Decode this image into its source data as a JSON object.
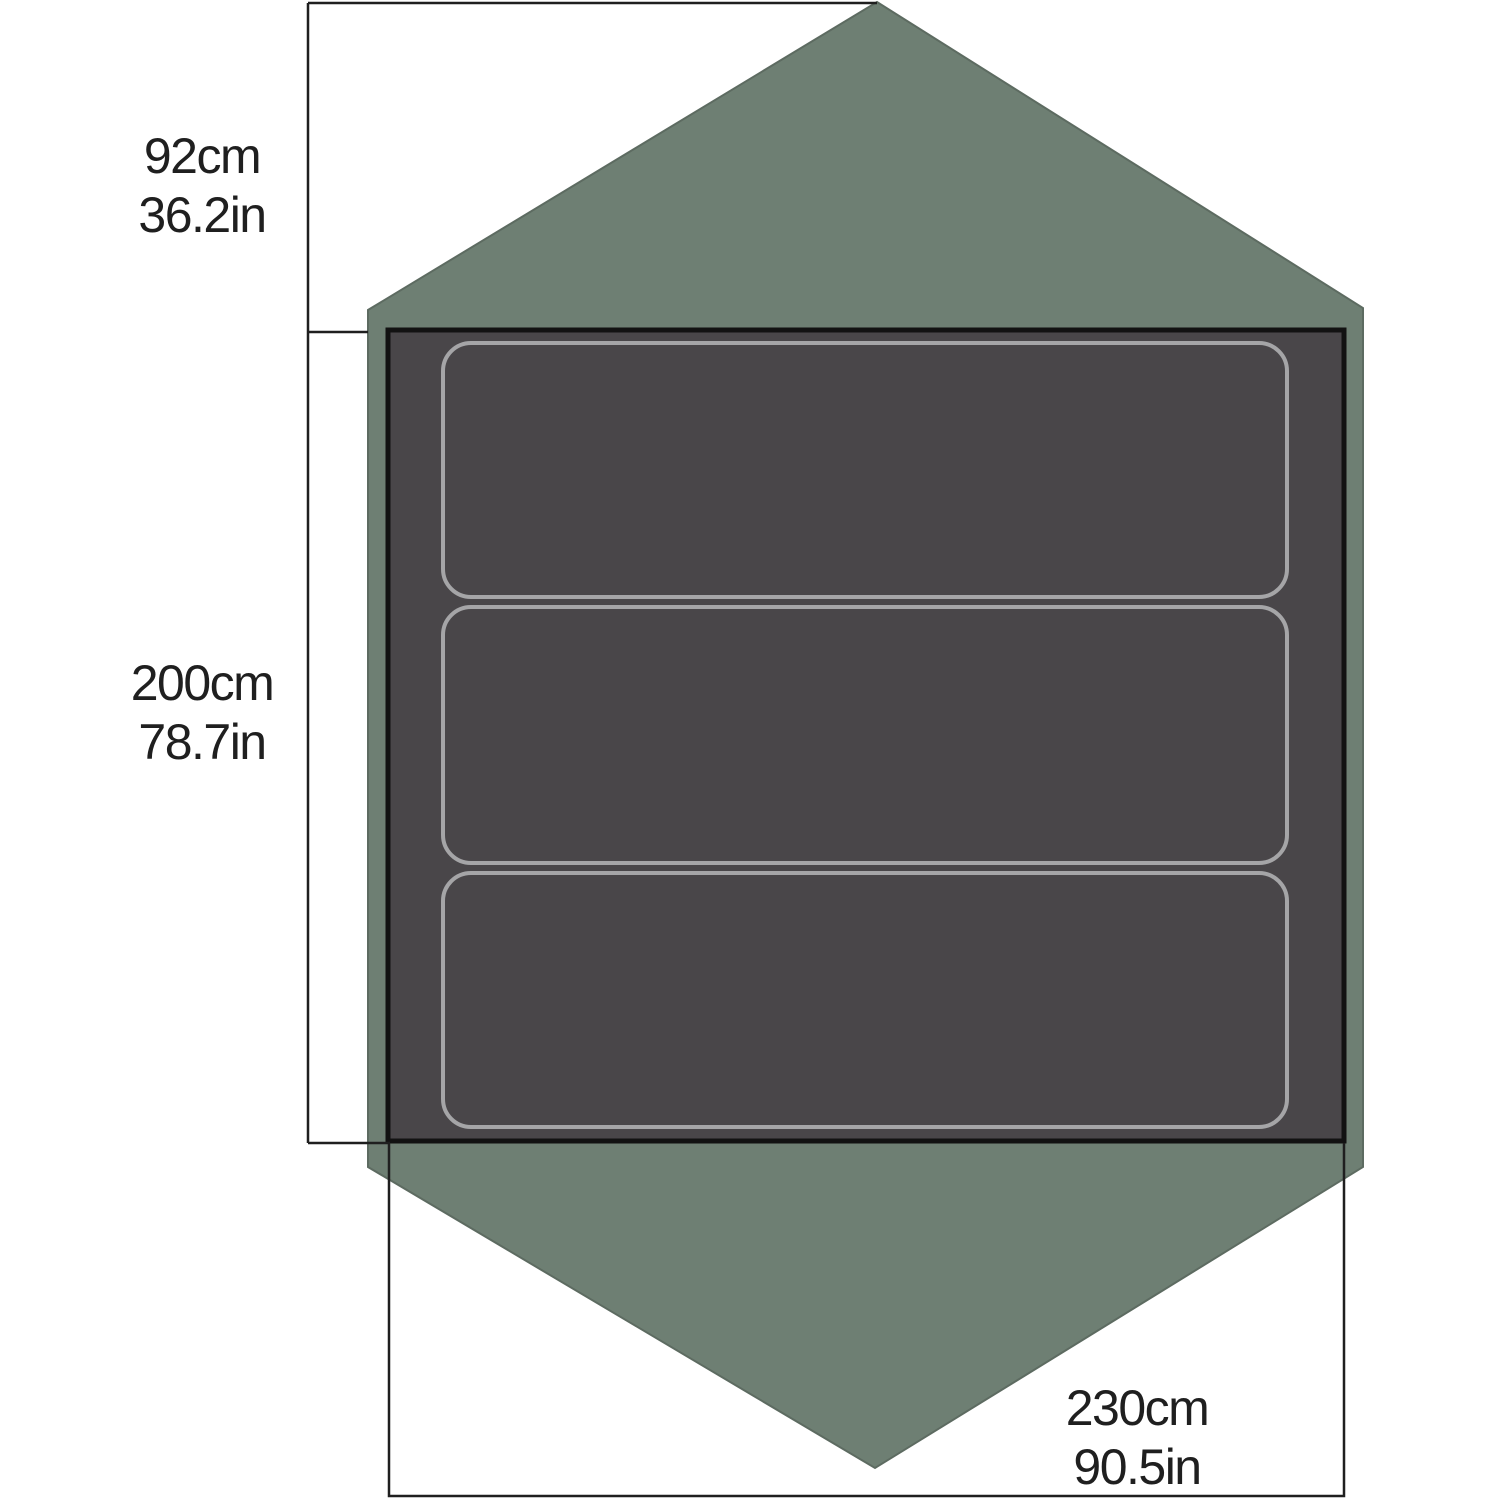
{
  "diagram": {
    "kind": "tent-floorplan-dimensions",
    "sleeping_pad_count": 3,
    "labels": {
      "vestibule_depth": {
        "metric": "92cm",
        "imperial": "36.2in"
      },
      "floor_length": {
        "metric": "200cm",
        "imperial": "78.7in"
      },
      "floor_width": {
        "metric": "230cm",
        "imperial": "90.5in"
      }
    },
    "colors": {
      "background": "#ffffff",
      "fly_green": "#6e7f73",
      "fly_edge": "#5d6b61",
      "floor_gray": "#494649",
      "floor_border": "#121212",
      "pad_outline": "#a5a5a7",
      "dimension_line": "#1f1f1f",
      "text": "#1f1f1f"
    }
  }
}
